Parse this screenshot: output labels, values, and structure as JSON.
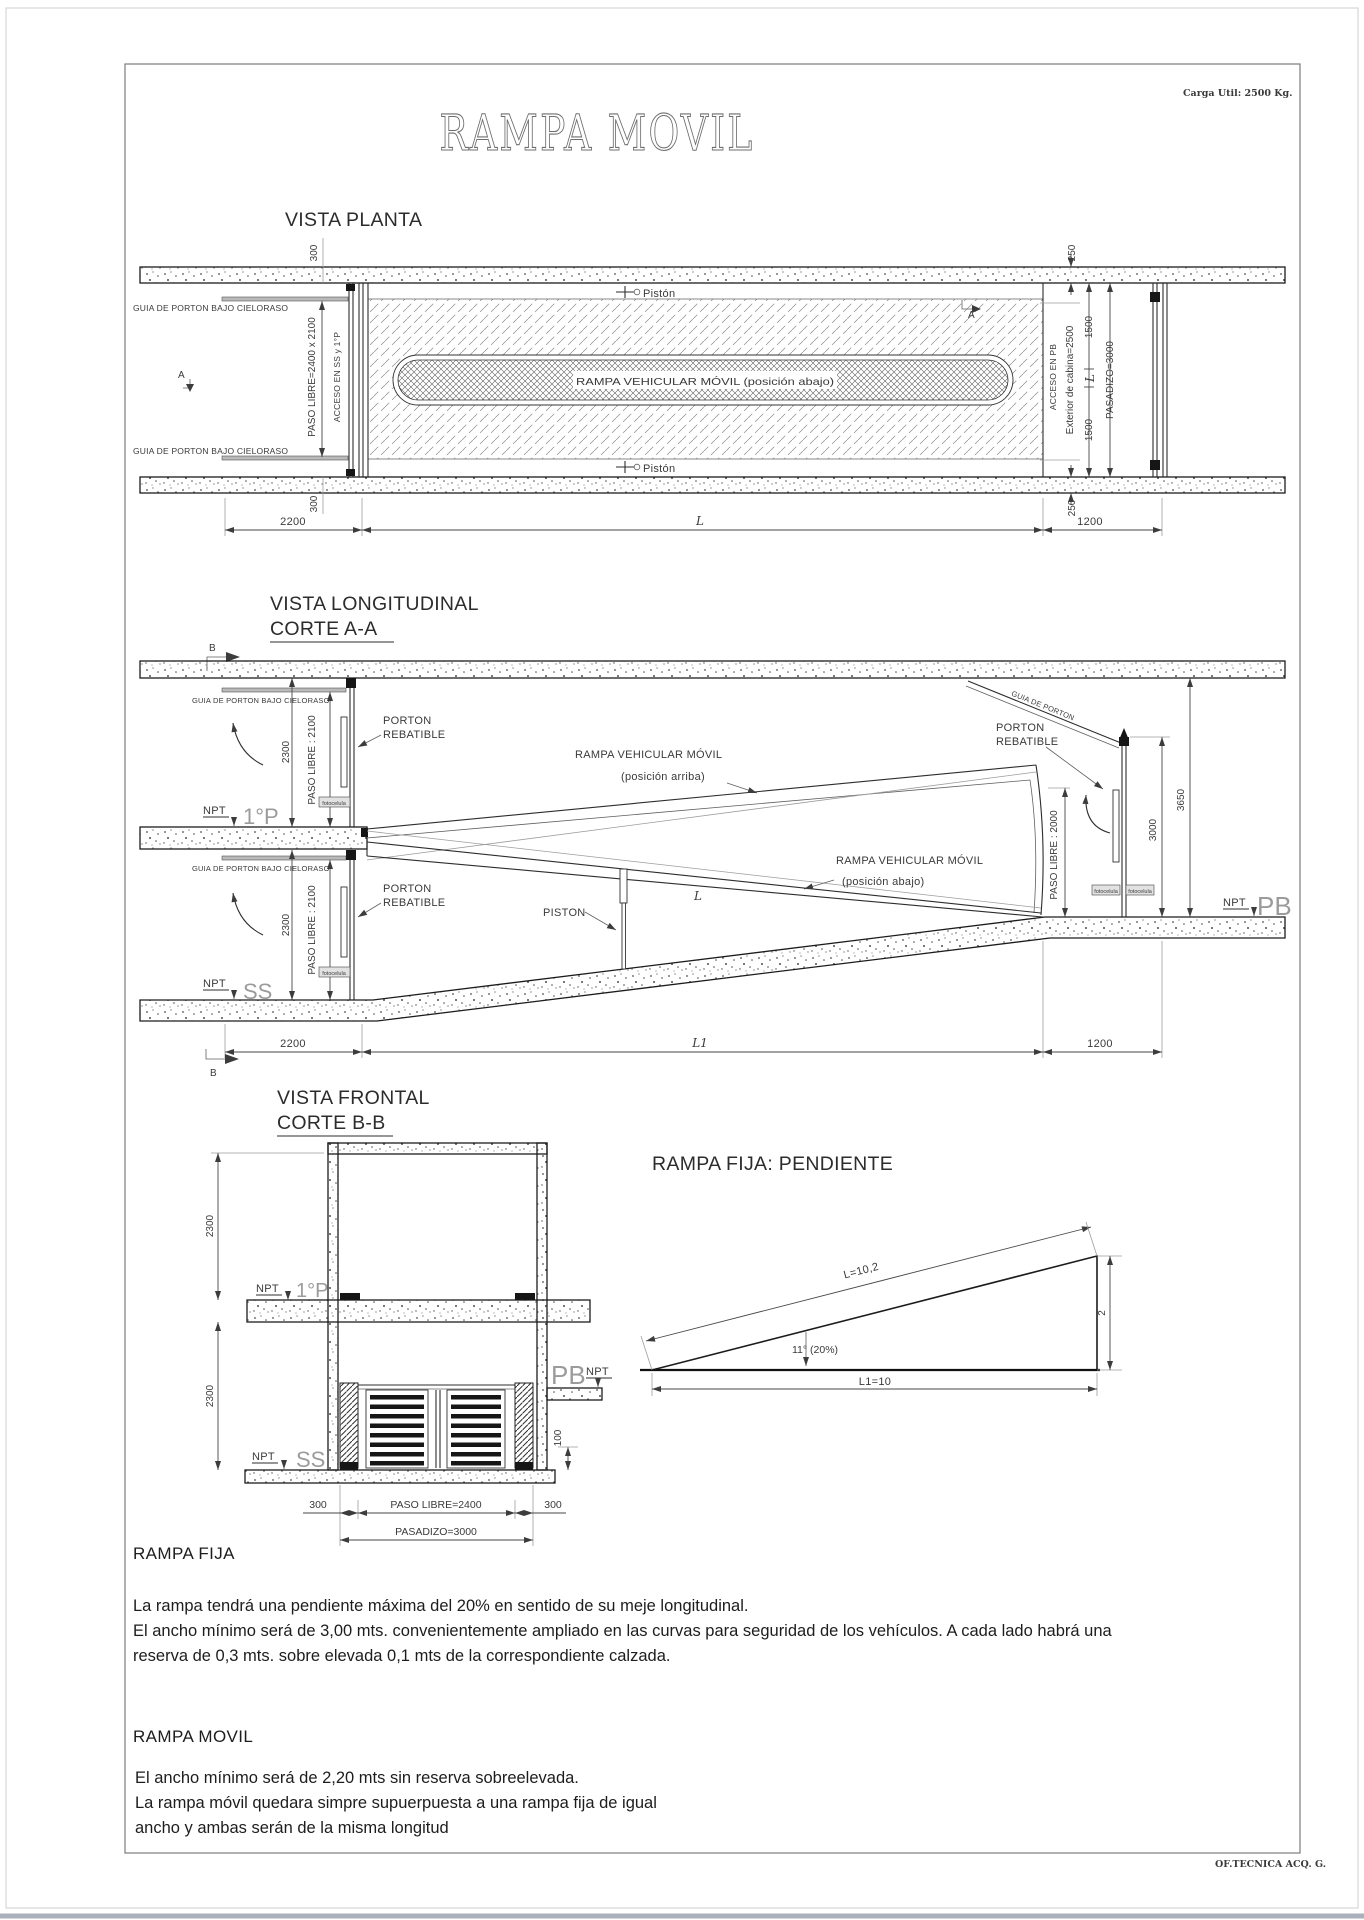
{
  "page": {
    "carga_util": "Carga Util: 2500 Kg.",
    "title": "RAMPA MOVIL",
    "footer": "OF.TECNICA ACQ. G."
  },
  "plan": {
    "title": "VISTA PLANTA",
    "guia_top": "GUIA DE PORTON BAJO CIELORASO",
    "guia_bottom": "GUIA DE PORTON BAJO CIELORASO",
    "piston_top": "Pistón",
    "piston_bottom": "Pistón",
    "ramp_label": "RAMPA VEHICULAR MÓVIL (posición abajo)",
    "paso_libre": "PASO LIBRE=2400 x 2100",
    "acceso_ss": "ACCESO EN SS y 1°P",
    "acceso_pb": "ACCESO EN PB",
    "exterior_cabina": "Exterior de cabina=2500",
    "pasadizo": "PASADIZO=3000",
    "marker_a_left": "A",
    "marker_a_right": "A",
    "dim_300_top": "300",
    "dim_300_bottom": "300",
    "dim_250_top": "250",
    "dim_250_bottom": "250",
    "dim_1500_top": "1500",
    "dim_l_mid": "L",
    "dim_1500_bottom": "1500",
    "dim_2200": "2200",
    "dim_l_bottom": "L",
    "dim_1200": "1200"
  },
  "longitudinal": {
    "title": "VISTA LONGITUDINAL",
    "subtitle": "CORTE  A-A",
    "marker_b_top": "B",
    "marker_b_bottom": "B",
    "guia_1p": "GUIA DE PORTON BAJO CIELORASO",
    "guia_ss": "GUIA DE PORTON BAJO CIELORASO",
    "dim_2300_1p": "2300",
    "dim_2300_ss": "2300",
    "paso_2100_1p": "PASO LIBRE : 2100",
    "paso_2100_ss": "PASO LIBRE : 2100",
    "porton_l1": "PORTON",
    "porton_l2": "REBATIBLE",
    "fotocelula": "fotocelula",
    "npt": "NPT",
    "level_1p": "1°P",
    "level_ss": "SS",
    "level_pb": "PB",
    "ramp_up_l1": "RAMPA VEHICULAR MÓVIL",
    "ramp_up_l2": "(posición  arriba)",
    "ramp_down_l1": "RAMPA VEHICULAR MÓVIL",
    "ramp_down_l2": "(posición  abajo)",
    "piston": "PISTON",
    "dim_l_ramp": "L",
    "guia_porton": "GUIA DE PORTON",
    "paso_2000": "PASO LIBRE : 2000",
    "dim_3000": "3000",
    "dim_3650": "3650",
    "dim_2200": "2200",
    "dim_l1": "L1",
    "dim_1200": "1200"
  },
  "frontal": {
    "title": "VISTA FRONTAL",
    "subtitle": "CORTE  B-B",
    "dim_2300_top": "2300",
    "dim_2300_bottom": "2300",
    "npt": "NPT",
    "level_1p": "1°P",
    "level_ss": "SS",
    "level_pb": "PB",
    "dim_100": "100",
    "dim_300_left": "300",
    "paso_libre": "PASO LIBRE=2400",
    "dim_300_right": "300",
    "pasadizo": "PASADIZO=3000"
  },
  "pendiente": {
    "title": "RAMPA FIJA: PENDIENTE",
    "hyp": "L=10,2",
    "angle": "11°  (20%)",
    "height": "2",
    "base": "L1=10"
  },
  "notes": {
    "fija_heading": "RAMPA FIJA",
    "fija_lines": [
      "La rampa tendrá una pendiente máxima del 20% en sentido de su meje longitudinal.",
      "El ancho mínimo será de 3,00 mts. convenientemente ampliado en  las curvas para seguridad de los vehículos. A cada lado habrá una",
      "reserva de 0,3 mts. sobre elevada 0,1 mts de la correspondiente calzada."
    ],
    "movil_heading": "RAMPA  MOVIL",
    "movil_lines": [
      "El ancho mínimo será de 2,20 mts sin reserva sobreelevada.",
      "La rampa móvil quedara simpre supuerpuesta a una rampa fija de igual",
      "ancho y ambas serán de la misma longitud"
    ]
  }
}
